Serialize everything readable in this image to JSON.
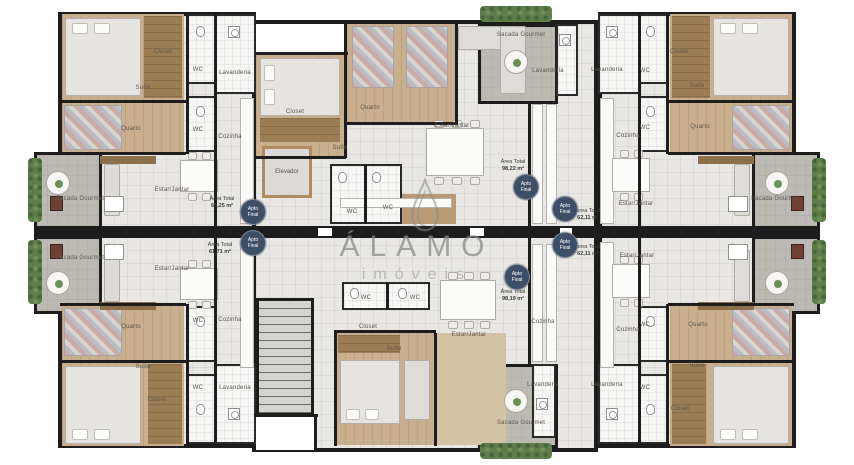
{
  "watermark": {
    "brand": "ÁLAMO",
    "sub": "imóveis"
  },
  "labels": {
    "suite": "Suíte",
    "quarto": "Quarto",
    "closet": "Closet",
    "wc": "WC",
    "cozinha": "Cozinha",
    "lavanderia": "Lavanderia",
    "sacada_gourmet": "Sacada Gourmet",
    "estar_jantar": "Estar/Jantar",
    "elevador": "Elevador",
    "area_total": "Área Total"
  },
  "badge": {
    "line1": "Apto",
    "line2": "Final"
  },
  "apartments": {
    "top_left": {
      "area": "61,25 m²"
    },
    "bottom_left": {
      "area": "61,71 m²"
    },
    "top_center": {
      "area": "98,22 m²"
    },
    "bottom_center": {
      "area": "98,19 m²"
    },
    "top_right": {
      "area": "62,11 m²"
    },
    "bottom_right": {
      "area": "62,11 m²"
    }
  },
  "colors": {
    "wall": "#1d1d1d",
    "wood": "#c9af8d",
    "wood_dark": "#9c7c55",
    "floor": "#e8e7e4",
    "sacada": "#bdbab4",
    "hedge": "#5d7d4a",
    "badge_bg": "#3d4f66",
    "watermark": "#8a8a8a"
  }
}
